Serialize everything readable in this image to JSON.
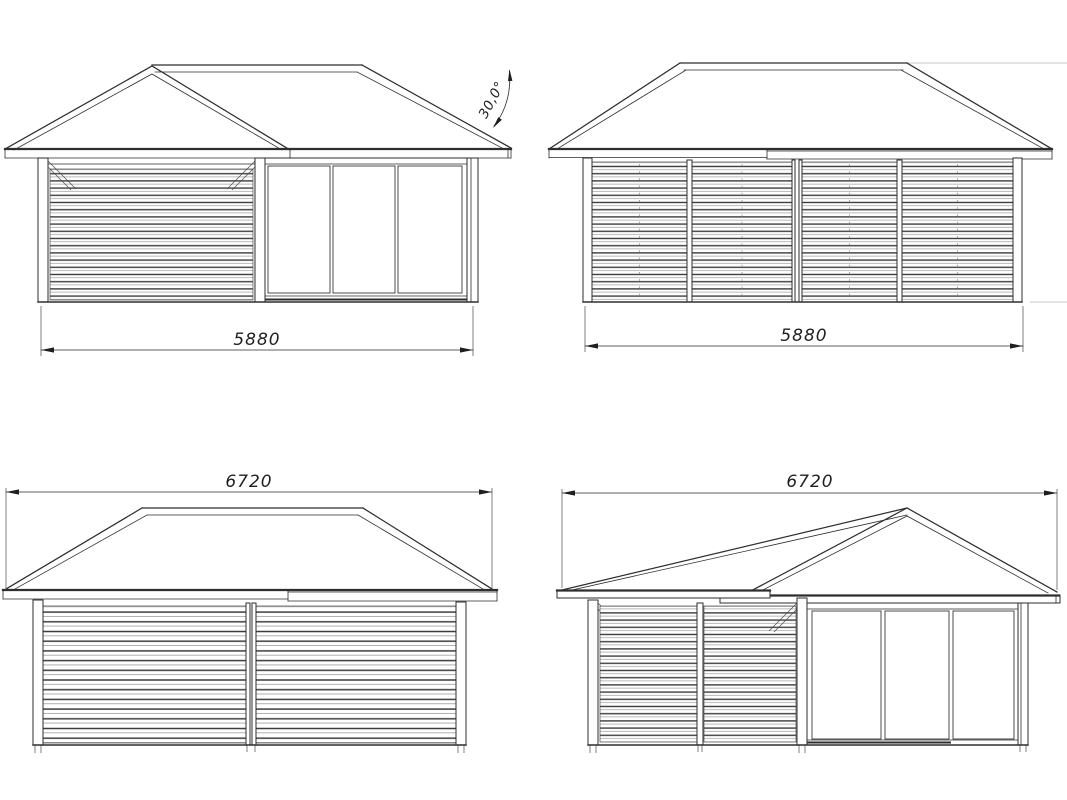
{
  "drawing": {
    "type": "technical-elevation-drawing",
    "subject": "garden house / gazebo elevations",
    "background": "#ffffff"
  },
  "colors": {
    "line": "#2e2e2e",
    "line_light": "#9b9b9b",
    "line_faint": "#c9c9c9",
    "dim_text": "#1f1f1f"
  },
  "views": {
    "front_elevation": {
      "dimension_mm": "5880",
      "roof_angle": "30,0°"
    },
    "side_elevation": {
      "dimension_mm": "5880"
    },
    "rear_elevation": {
      "dimension_mm": "6720"
    },
    "side_elevation_2": {
      "dimension_mm": "6720"
    }
  }
}
